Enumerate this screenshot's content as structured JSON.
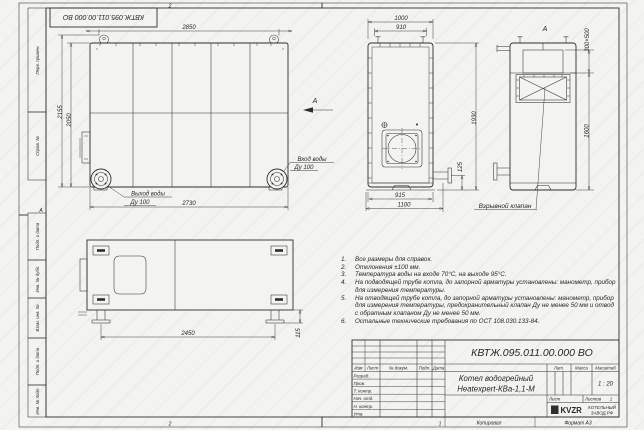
{
  "sheet": {
    "paper_color": "#f3f3ef",
    "line_color": "#2e2e2c",
    "doc_code_rotated": "КВТЖ.095.011.00.000 ВО",
    "zone_top": "2",
    "zone_bottom": "2",
    "zone_bottom_right": "1",
    "zone_left": "А"
  },
  "margin": {
    "perv_primen": "Перв. примен.",
    "sprav_no": "Справ. №",
    "podp_data_1": "Подп. и дата",
    "inv_dubl": "Инв. № дубл.",
    "vzam_inv": "Взам. инв. №",
    "podp_data_2": "Подп. и дата",
    "inv_podl": "Инв. № подл."
  },
  "front_view": {
    "dim_2850": "2850",
    "dim_2155": "2155",
    "dim_2050": "2050",
    "dim_2730": "2730",
    "outlet_line1": "Выход воды",
    "outlet_line2": "Ду 100",
    "inlet_line1": "Вход воды",
    "inlet_line2": "Ду 100",
    "view_arrow": "А"
  },
  "middle_view": {
    "dim_1000": "1000",
    "dim_910": "910",
    "dim_1930": "1930",
    "dim_125": "125",
    "dim_915": "915",
    "dim_1100": "1100"
  },
  "side_view": {
    "view_label": "А",
    "dim_300x500": "300×500",
    "dim_1600": "1600",
    "valve_label": "Взрывной клапан"
  },
  "plan_view": {
    "dim_2450": "2450",
    "dim_115": "115"
  },
  "notes": [
    {
      "n": "1.",
      "text": "Все размеры для справок."
    },
    {
      "n": "2.",
      "text": "Отклонения ±100 мм."
    },
    {
      "n": "3.",
      "text": "Температура воды на входе 70°С, на выходе 95°С."
    },
    {
      "n": "4.",
      "text": "На подводящей трубе котла, до запорной арматуры установлены: манометр, прибор для измерения температуры."
    },
    {
      "n": "5.",
      "text": "На отводящей трубе котла, до запорной арматуры установлены: манометр, прибор для измерения температуры, предохранительный клапан Ду не менее 50 мм и отвод с обратным клапаном Ду не менее 50 мм."
    },
    {
      "n": "6.",
      "text": "Остальные технические требования по ОСТ 108.030.133-84."
    }
  ],
  "title_block": {
    "doc_number": "КВТЖ.095.011.00.000 ВО",
    "product_line1": "Котел водогрейный",
    "product_line2": "Heatexpert-КВа-1,1-М",
    "col_izm": "Изм",
    "col_list": "Лист",
    "col_docnum": "№ докум.",
    "col_podp": "Подп.",
    "col_data": "Дата",
    "row_razrab": "Разраб.",
    "row_prov": "Пров.",
    "row_tkontr": "Т. контр.",
    "row_nachotd": "Нач. отд.",
    "row_nkontr": "Н. контр.",
    "row_utv": "Утв.",
    "lit_label": "Лит.",
    "massa_label": "Масса",
    "masshtab_label": "Масштаб",
    "scale": "1 : 20",
    "list_label": "Лист",
    "listov_label": "Листов",
    "listov_value": "1",
    "logo": "KVZR",
    "company_line1": "КОТЕЛЬНЫЙ",
    "company_line2": "ЗАВОД.РФ",
    "kopiroval": "Копировал",
    "format": "Формат А3"
  }
}
